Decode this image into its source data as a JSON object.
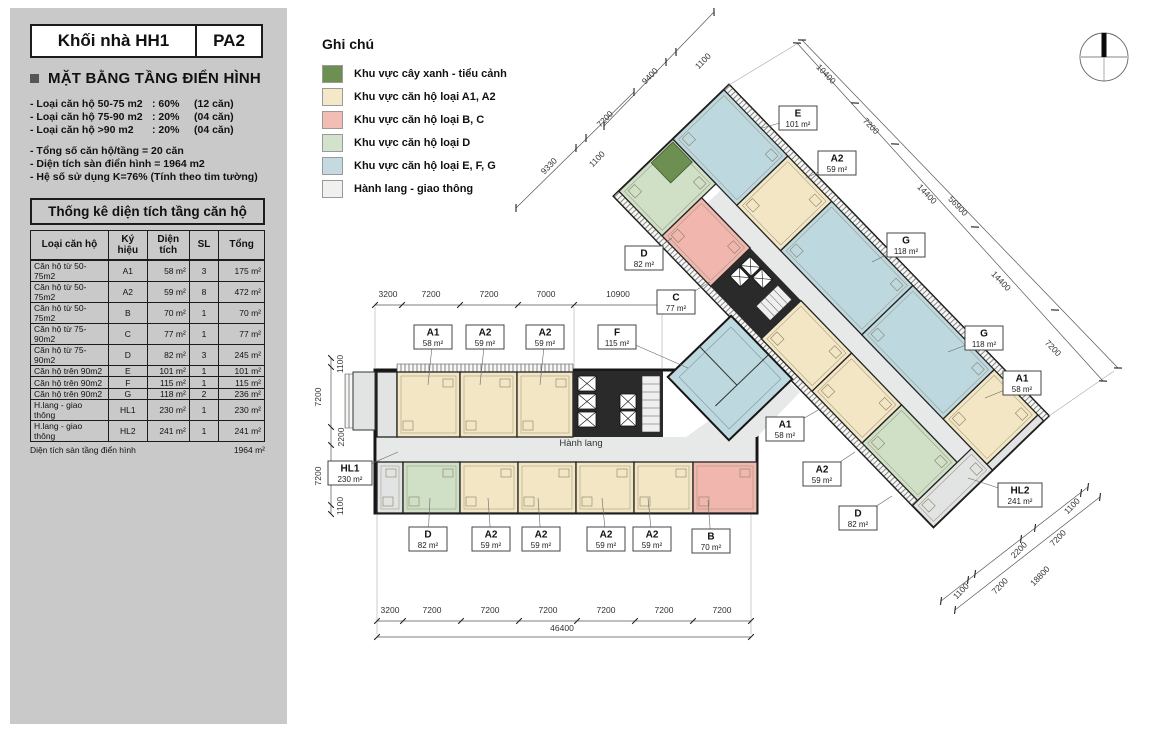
{
  "header": {
    "block": "Khối nhà HH1",
    "variant": "PA2"
  },
  "sidebar": {
    "section_title": "MẶT BẰNG TẦNG ĐIỂN HÌNH",
    "stats": [
      {
        "label": "- Loại căn hộ 50-75 m2",
        "pct": ": 60%",
        "count": "(12 căn)"
      },
      {
        "label": "- Loại căn hộ 75-90 m2",
        "pct": ": 20%",
        "count": "(04 căn)"
      },
      {
        "label": "- Loại căn hộ >90 m2",
        "pct": ": 20%",
        "count": "(04 căn)"
      }
    ],
    "summary": [
      "- Tổng số căn hộ/tầng      =    20 căn",
      "- Diện tích sàn điển hình  = 1964 m2",
      "- Hệ số sử dụng K=76% (Tính theo tim tường)"
    ]
  },
  "table": {
    "title": "Thống kê diện tích tầng căn hộ",
    "headers": [
      "Loại căn hộ",
      "Ký hiệu",
      "Diện tích",
      "SL",
      "Tổng"
    ],
    "rows": [
      [
        "Căn hộ từ 50-75m2",
        "A1",
        "58 m²",
        "3",
        "175 m²"
      ],
      [
        "Căn hộ từ 50-75m2",
        "A2",
        "59 m²",
        "8",
        "472 m²"
      ],
      [
        "Căn hộ từ 50-75m2",
        "B",
        "70 m²",
        "1",
        "70 m²"
      ],
      [
        "Căn hộ từ 75-90m2",
        "C",
        "77 m²",
        "1",
        "77 m²"
      ],
      [
        "Căn hộ từ 75-90m2",
        "D",
        "82 m²",
        "3",
        "245 m²"
      ],
      [
        "Căn hộ  trên  90m2",
        "E",
        "101 m²",
        "1",
        "101 m²"
      ],
      [
        "Căn hộ  trên  90m2",
        "F",
        "115 m²",
        "1",
        "115 m²"
      ],
      [
        "Căn hộ  trên  90m2",
        "G",
        "118 m²",
        "2",
        "236 m²"
      ],
      [
        "H.lang - giao thông",
        "HL1",
        "230 m²",
        "1",
        "230 m²"
      ],
      [
        "H.lang - giao thông",
        "HL2",
        "241 m²",
        "1",
        "241 m²"
      ]
    ],
    "footer_label": "Diện tích sàn tầng điển hình",
    "footer_value": "1964 m²"
  },
  "legend": {
    "title": "Ghi chú",
    "items": [
      {
        "label": "Khu vực cây xanh - tiểu cảnh",
        "color": "#6d8f51"
      },
      {
        "label": "Khu vực căn hộ loại A1, A2",
        "color": "#f5e8c9"
      },
      {
        "label": "Khu vực căn hộ loại B, C",
        "color": "#f2bdb4"
      },
      {
        "label": "Khu vực căn hộ loại D",
        "color": "#d3e2cc"
      },
      {
        "label": "Khu vực căn hộ loại E, F, G",
        "color": "#c4d9e0"
      },
      {
        "label": "Hành lang - giao thông",
        "color": "#f0f1ef"
      }
    ]
  },
  "plan": {
    "corridor_label": "Hành lang",
    "colors": {
      "cream": "#f2e6c4",
      "pink": "#f1b6ad",
      "green": "#cfe0c6",
      "blue": "#bed8df",
      "gray": "#e2e4e3",
      "dgreen": "#6d8f51",
      "corridor": "#e7e9e8",
      "wall": "#161616"
    },
    "h_units": [
      {
        "x": 377,
        "y": 372,
        "w": 20,
        "h": 65,
        "c": "gray"
      },
      {
        "x": 397,
        "y": 372,
        "w": 63,
        "h": 65,
        "c": "cream"
      },
      {
        "x": 460,
        "y": 372,
        "w": 57,
        "h": 65,
        "c": "cream"
      },
      {
        "x": 517,
        "y": 372,
        "w": 56,
        "h": 65,
        "c": "cream"
      },
      {
        "x": 377,
        "y": 462,
        "w": 26,
        "h": 51,
        "c": "gray"
      },
      {
        "x": 403,
        "y": 462,
        "w": 57,
        "h": 51,
        "c": "green"
      },
      {
        "x": 460,
        "y": 462,
        "w": 58,
        "h": 51,
        "c": "cream"
      },
      {
        "x": 518,
        "y": 462,
        "w": 58,
        "h": 51,
        "c": "cream"
      },
      {
        "x": 576,
        "y": 462,
        "w": 58,
        "h": 51,
        "c": "cream"
      },
      {
        "x": 634,
        "y": 462,
        "w": 59,
        "h": 51,
        "c": "cream"
      },
      {
        "x": 693,
        "y": 462,
        "w": 64,
        "h": 51,
        "c": "pink"
      }
    ],
    "d_units": [
      {
        "x": 0,
        "y": 7,
        "w": 92,
        "h": 71,
        "c": "blue"
      },
      {
        "x": 92,
        "y": 7,
        "w": 63,
        "h": 71,
        "c": "cream"
      },
      {
        "x": 155,
        "y": 7,
        "w": 117,
        "h": 71,
        "c": "blue"
      },
      {
        "x": 272,
        "y": 7,
        "w": 117,
        "h": 71,
        "c": "blue"
      },
      {
        "x": 389,
        "y": 7,
        "w": 63,
        "h": 71,
        "c": "cream"
      },
      {
        "x": 452,
        "y": 7,
        "w": 8,
        "h": 71,
        "c": "gray"
      },
      {
        "x": 0,
        "y": 78,
        "w": 62,
        "h": 75,
        "c": "green"
      },
      {
        "x": 62,
        "y": 98,
        "w": 70,
        "h": 55,
        "c": "pink"
      },
      {
        "x": 205,
        "y": 98,
        "w": 73,
        "h": 55,
        "c": "cream"
      },
      {
        "x": 278,
        "y": 98,
        "w": 72,
        "h": 55,
        "c": "cream"
      },
      {
        "x": 350,
        "y": 98,
        "w": 80,
        "h": 55,
        "c": "green"
      },
      {
        "x": 430,
        "y": 78,
        "w": 30,
        "h": 82,
        "c": "gray"
      }
    ],
    "lifts_abs": [
      [
        578,
        376,
        18,
        15
      ],
      [
        578,
        394,
        18,
        15
      ],
      [
        578,
        412,
        18,
        15
      ],
      [
        620,
        394,
        16,
        15
      ],
      [
        620,
        411,
        16,
        15
      ]
    ],
    "lifts_local": [
      [
        138,
        104,
        15,
        13
      ],
      [
        155,
        104,
        15,
        13
      ],
      [
        138,
        119,
        15,
        13
      ]
    ],
    "unit_labels": [
      {
        "code": "A1",
        "area": "58 m²",
        "x": 433,
        "y": 337,
        "lx": 428,
        "ly": 385
      },
      {
        "code": "A2",
        "area": "59 m²",
        "x": 485,
        "y": 337,
        "lx": 480,
        "ly": 385
      },
      {
        "code": "A2",
        "area": "59 m²",
        "x": 545,
        "y": 337,
        "lx": 540,
        "ly": 385
      },
      {
        "code": "F",
        "area": "115 m²",
        "x": 617,
        "y": 337,
        "lx": 688,
        "ly": 368
      },
      {
        "code": "C",
        "area": "77 m²",
        "x": 676,
        "y": 302,
        "lx": 710,
        "ly": 282
      },
      {
        "code": "D",
        "area": "82 m²",
        "x": 428,
        "y": 539,
        "lx": 430,
        "ly": 498
      },
      {
        "code": "A2",
        "area": "59 m²",
        "x": 491,
        "y": 539,
        "lx": 488,
        "ly": 498
      },
      {
        "code": "A2",
        "area": "59 m²",
        "x": 541,
        "y": 539,
        "lx": 538,
        "ly": 498
      },
      {
        "code": "A2",
        "area": "59 m²",
        "x": 606,
        "y": 539,
        "lx": 602,
        "ly": 498
      },
      {
        "code": "A2",
        "area": "59 m²",
        "x": 652,
        "y": 539,
        "lx": 648,
        "ly": 498
      },
      {
        "code": "B",
        "area": "70 m²",
        "x": 711,
        "y": 541,
        "lx": 708,
        "ly": 500
      },
      {
        "code": "HL1",
        "area": "230 m²",
        "x": 350,
        "y": 473,
        "lx": 398,
        "ly": 452
      },
      {
        "code": "D",
        "area": "82 m²",
        "x": 644,
        "y": 258,
        "lx": 672,
        "ly": 238
      },
      {
        "code": "E",
        "area": "101 m²",
        "x": 798,
        "y": 118,
        "lx": 762,
        "ly": 128
      },
      {
        "code": "A2",
        "area": "59 m²",
        "x": 837,
        "y": 163,
        "lx": 806,
        "ly": 178
      },
      {
        "code": "G",
        "area": "118 m²",
        "x": 906,
        "y": 245,
        "lx": 872,
        "ly": 262
      },
      {
        "code": "G",
        "area": "118 m²",
        "x": 984,
        "y": 338,
        "lx": 948,
        "ly": 352
      },
      {
        "code": "A1",
        "area": "58 m²",
        "x": 1022,
        "y": 383,
        "lx": 985,
        "ly": 398
      },
      {
        "code": "A1",
        "area": "58 m²",
        "x": 785,
        "y": 429,
        "lx": 820,
        "ly": 409
      },
      {
        "code": "A2",
        "area": "59 m²",
        "x": 822,
        "y": 474,
        "lx": 855,
        "ly": 452
      },
      {
        "code": "D",
        "area": "82 m²",
        "x": 858,
        "y": 518,
        "lx": 892,
        "ly": 496
      },
      {
        "code": "HL2",
        "area": "241 m²",
        "x": 1020,
        "y": 495,
        "lx": 968,
        "ly": 478
      }
    ],
    "dim_labels": [
      {
        "t": "3200",
        "x": 388,
        "y": 297,
        "r": 0
      },
      {
        "t": "7200",
        "x": 431,
        "y": 297,
        "r": 0
      },
      {
        "t": "7200",
        "x": 489,
        "y": 297,
        "r": 0
      },
      {
        "t": "7000",
        "x": 546,
        "y": 297,
        "r": 0
      },
      {
        "t": "10900",
        "x": 618,
        "y": 297,
        "r": 0
      },
      {
        "t": "3200",
        "x": 390,
        "y": 613,
        "r": 0
      },
      {
        "t": "7200",
        "x": 432,
        "y": 613,
        "r": 0
      },
      {
        "t": "7200",
        "x": 490,
        "y": 613,
        "r": 0
      },
      {
        "t": "7200",
        "x": 548,
        "y": 613,
        "r": 0
      },
      {
        "t": "7200",
        "x": 606,
        "y": 613,
        "r": 0
      },
      {
        "t": "7200",
        "x": 664,
        "y": 613,
        "r": 0
      },
      {
        "t": "7200",
        "x": 722,
        "y": 613,
        "r": 0
      },
      {
        "t": "46400",
        "x": 562,
        "y": 631,
        "r": 0
      },
      {
        "t": "1100",
        "x": 343,
        "y": 364,
        "r": -90
      },
      {
        "t": "7200",
        "x": 321,
        "y": 397,
        "r": -90
      },
      {
        "t": "2200",
        "x": 344,
        "y": 437,
        "r": -90
      },
      {
        "t": "7200",
        "x": 321,
        "y": 476,
        "r": -90
      },
      {
        "t": "1100",
        "x": 343,
        "y": 506,
        "r": -90
      },
      {
        "t": "9400",
        "x": 652,
        "y": 78,
        "r": -46
      },
      {
        "t": "1100",
        "x": 705,
        "y": 63,
        "r": -46
      },
      {
        "t": "10400",
        "x": 824,
        "y": 76,
        "r": 46
      },
      {
        "t": "7200",
        "x": 869,
        "y": 128,
        "r": 46
      },
      {
        "t": "14400",
        "x": 925,
        "y": 196,
        "r": 46
      },
      {
        "t": "56900",
        "x": 956,
        "y": 208,
        "r": 46
      },
      {
        "t": "14400",
        "x": 999,
        "y": 283,
        "r": 46
      },
      {
        "t": "7200",
        "x": 1051,
        "y": 350,
        "r": 46
      },
      {
        "t": "9330",
        "x": 551,
        "y": 168,
        "r": -46
      },
      {
        "t": "7200",
        "x": 607,
        "y": 121,
        "r": -46
      },
      {
        "t": "1100",
        "x": 599,
        "y": 161,
        "r": -46
      },
      {
        "t": "1100",
        "x": 1074,
        "y": 508,
        "r": -46
      },
      {
        "t": "7200",
        "x": 1060,
        "y": 540,
        "r": -46
      },
      {
        "t": "2200",
        "x": 1021,
        "y": 552,
        "r": -46
      },
      {
        "t": "18800",
        "x": 1042,
        "y": 578,
        "r": -46
      },
      {
        "t": "7200",
        "x": 1002,
        "y": 588,
        "r": -46
      },
      {
        "t": "1100",
        "x": 963,
        "y": 593,
        "r": -46
      }
    ],
    "dim_lines": [
      {
        "x1": 375,
        "y1": 305,
        "x2": 662,
        "y2": 305,
        "ticks": [
          [
            375,
            305
          ],
          [
            402,
            305
          ],
          [
            460,
            305
          ],
          [
            518,
            305
          ],
          [
            574,
            305
          ],
          [
            662,
            305
          ]
        ]
      },
      {
        "x1": 377,
        "y1": 621,
        "x2": 751,
        "y2": 621,
        "ticks": [
          [
            377,
            621
          ],
          [
            403,
            621
          ],
          [
            461,
            621
          ],
          [
            519,
            621
          ],
          [
            577,
            621
          ],
          [
            635,
            621
          ],
          [
            693,
            621
          ],
          [
            751,
            621
          ]
        ]
      },
      {
        "x1": 377,
        "y1": 637,
        "x2": 751,
        "y2": 637,
        "ticks": [
          [
            377,
            637
          ],
          [
            751,
            637
          ]
        ]
      },
      {
        "x1": 331,
        "y1": 358,
        "x2": 331,
        "y2": 514,
        "ticks": [
          [
            331,
            358
          ],
          [
            331,
            367
          ],
          [
            331,
            427
          ],
          [
            331,
            445
          ],
          [
            331,
            505
          ],
          [
            331,
            514
          ]
        ]
      },
      {
        "x1": 797,
        "y1": 43,
        "x2": 1103,
        "y2": 381,
        "ticks": [
          [
            797,
            43
          ],
          [
            855,
            103
          ],
          [
            895,
            144
          ],
          [
            975,
            227
          ],
          [
            1055,
            310
          ],
          [
            1103,
            381
          ]
        ]
      },
      {
        "x1": 802,
        "y1": 40,
        "x2": 1118,
        "y2": 368,
        "ticks": [
          [
            802,
            40
          ],
          [
            1118,
            368
          ]
        ]
      },
      {
        "x1": 604,
        "y1": 126,
        "x2": 714,
        "y2": 12,
        "ticks": [
          [
            604,
            126
          ],
          [
            666,
            62
          ],
          [
            676,
            52
          ],
          [
            714,
            12
          ]
        ]
      },
      {
        "x1": 516,
        "y1": 208,
        "x2": 634,
        "y2": 92,
        "ticks": [
          [
            516,
            208
          ],
          [
            576,
            148
          ],
          [
            586,
            138
          ],
          [
            634,
            92
          ]
        ]
      },
      {
        "x1": 1088,
        "y1": 487,
        "x2": 941,
        "y2": 601,
        "ticks": [
          [
            1088,
            487
          ],
          [
            1081,
            493
          ],
          [
            1035,
            528
          ],
          [
            1021,
            539
          ],
          [
            975,
            574
          ],
          [
            968,
            580
          ],
          [
            941,
            601
          ]
        ]
      },
      {
        "x1": 1100,
        "y1": 497,
        "x2": 955,
        "y2": 610,
        "ticks": [
          [
            1100,
            497
          ],
          [
            955,
            610
          ]
        ]
      }
    ],
    "proj_lines": [
      [
        375,
        307,
        375,
        368
      ],
      [
        574,
        307,
        574,
        368
      ],
      [
        662,
        307,
        662,
        368
      ],
      [
        377,
        515,
        377,
        634
      ],
      [
        751,
        515,
        751,
        634
      ],
      [
        729,
        85,
        800,
        42
      ],
      [
        1049,
        416,
        1114,
        371
      ]
    ]
  }
}
